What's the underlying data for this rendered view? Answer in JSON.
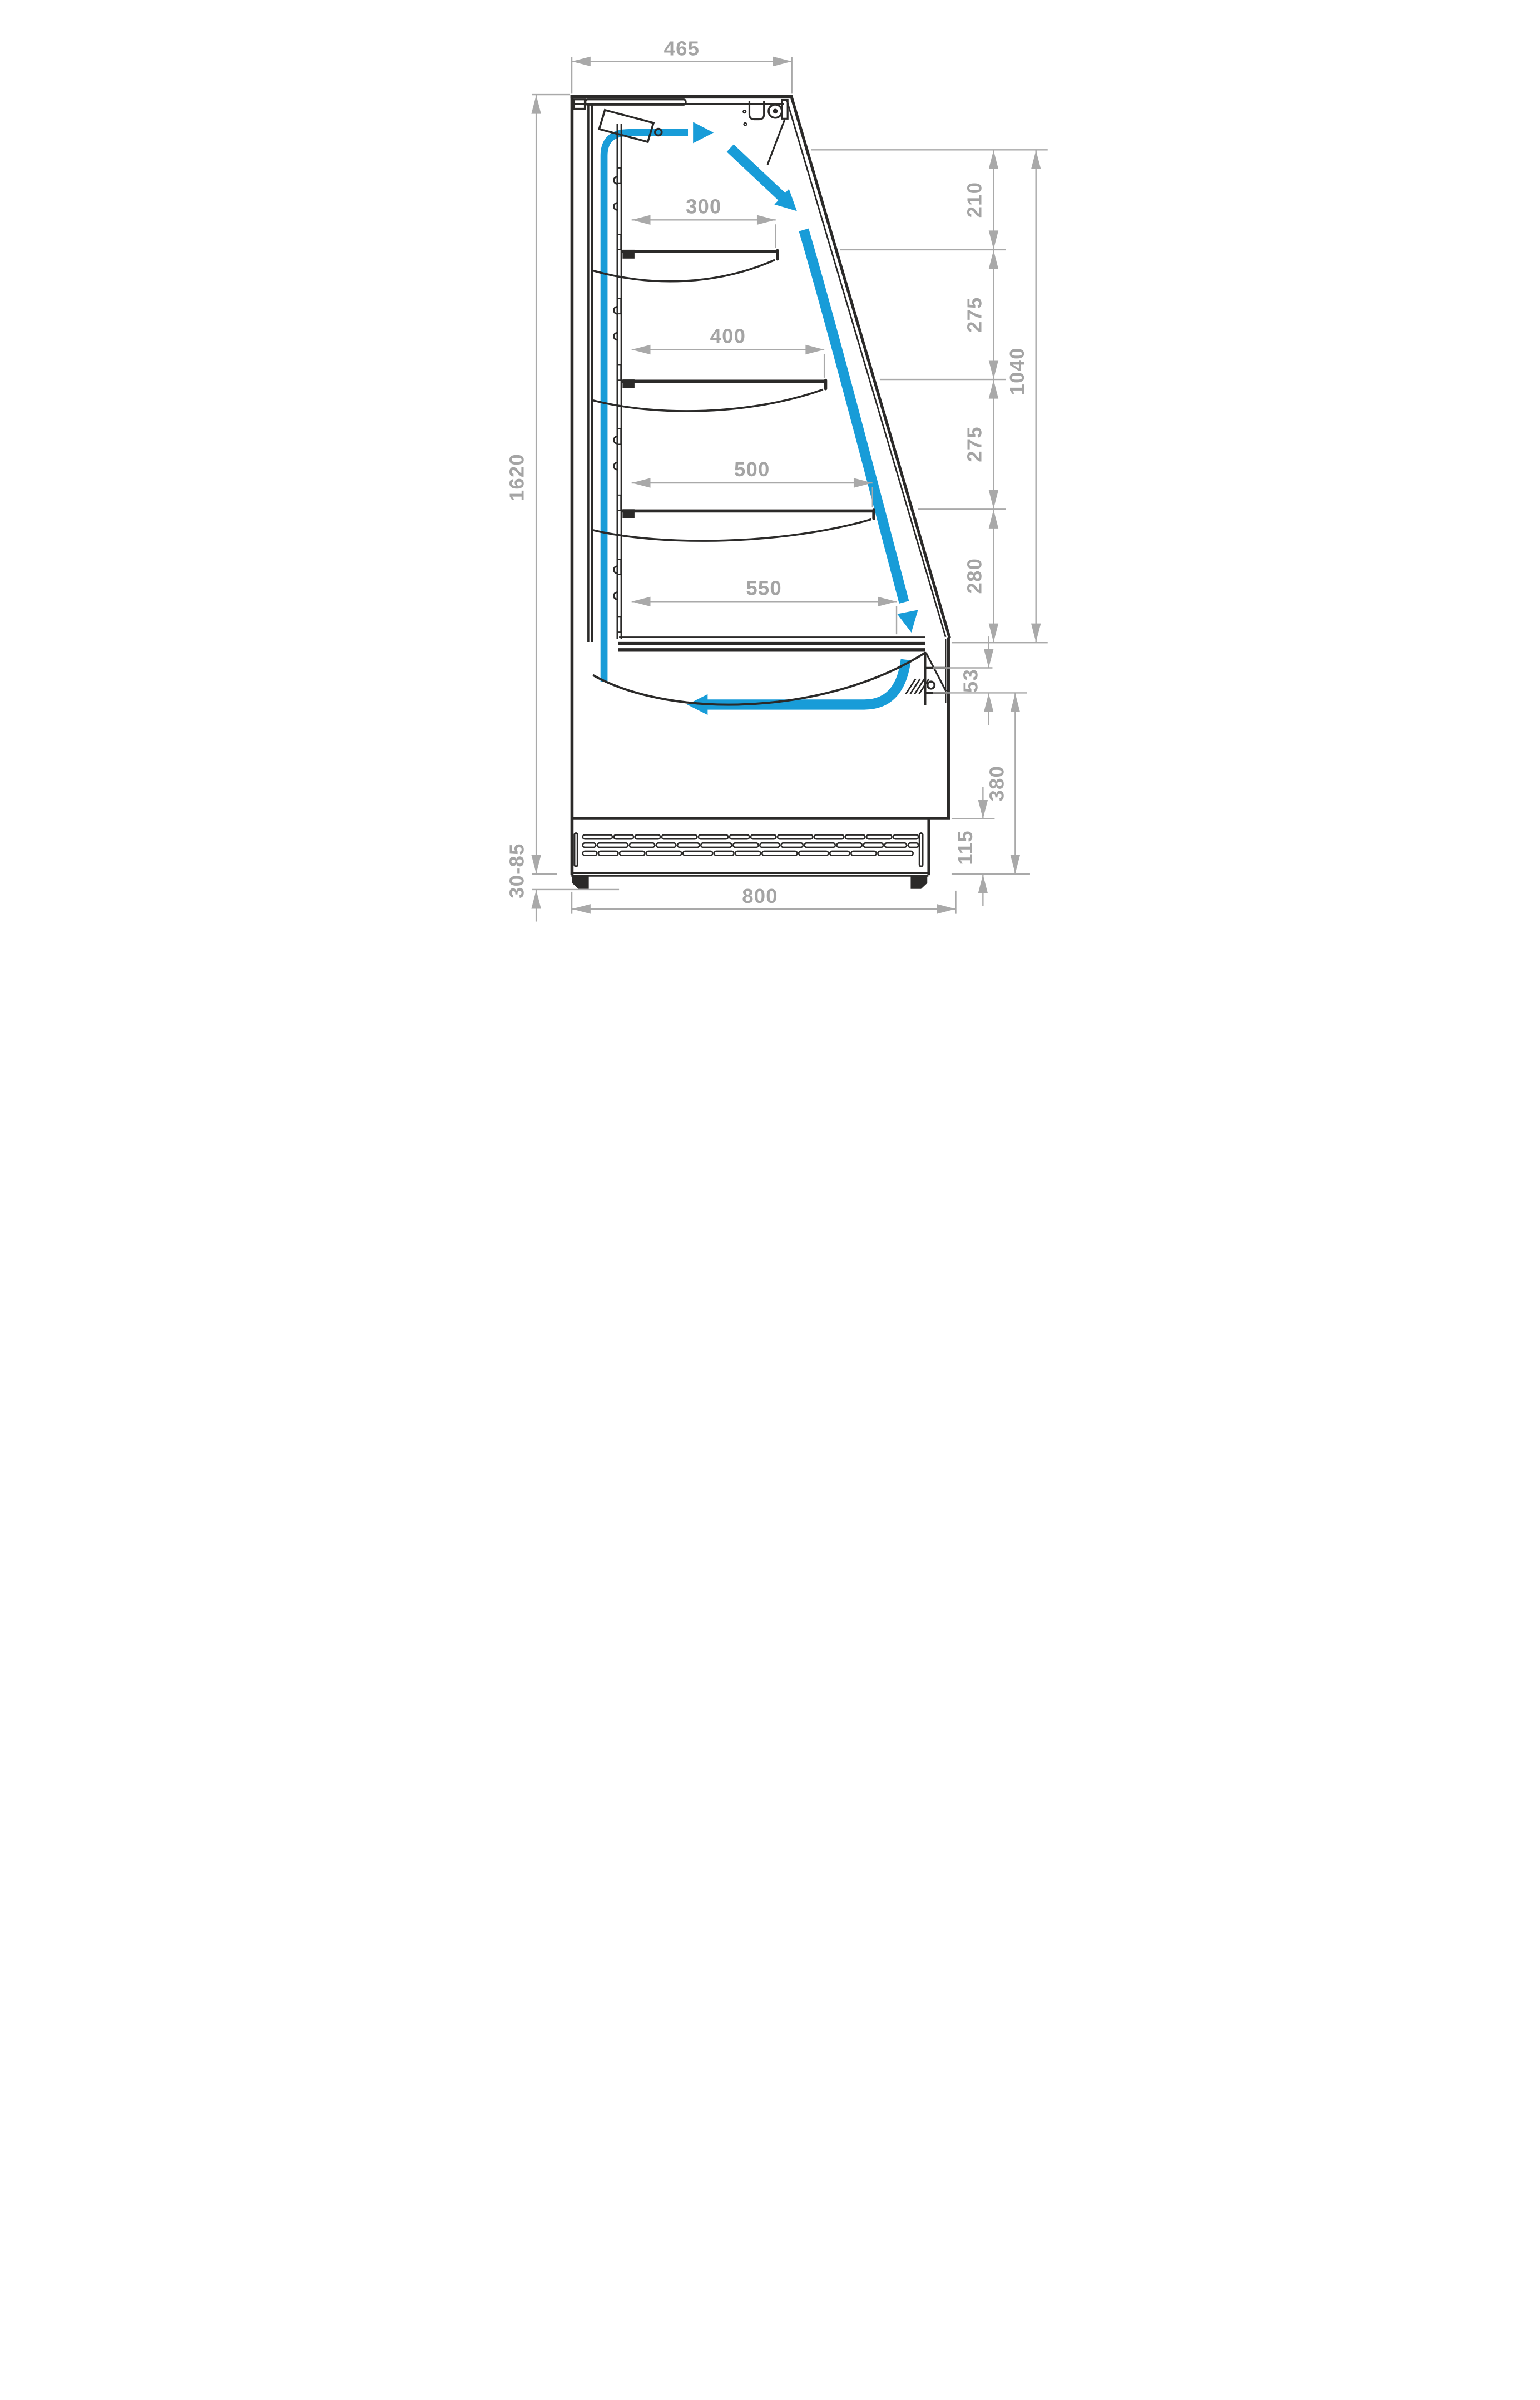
{
  "diagram": {
    "type": "technical-cross-section",
    "subject": "open-front refrigerated display case, side section with air-curtain flow",
    "units": "mm",
    "colors": {
      "linework": "#2b2a29",
      "dimensions": "#a4a4a4",
      "airflow": "#189cd8",
      "background": "#ffffff"
    },
    "dimensions": {
      "top_depth": "465",
      "overall_height": "1620",
      "feet_adjust_range": "30-85",
      "base_depth": "800",
      "front_opening_total": "1040",
      "vertical_spacings": [
        "210",
        "275",
        "275",
        "280"
      ],
      "shelf_depths": [
        "300",
        "400",
        "500",
        "550"
      ],
      "front_sill_height": "53",
      "base_section_height": "380",
      "vent_panel_height": "115"
    }
  }
}
